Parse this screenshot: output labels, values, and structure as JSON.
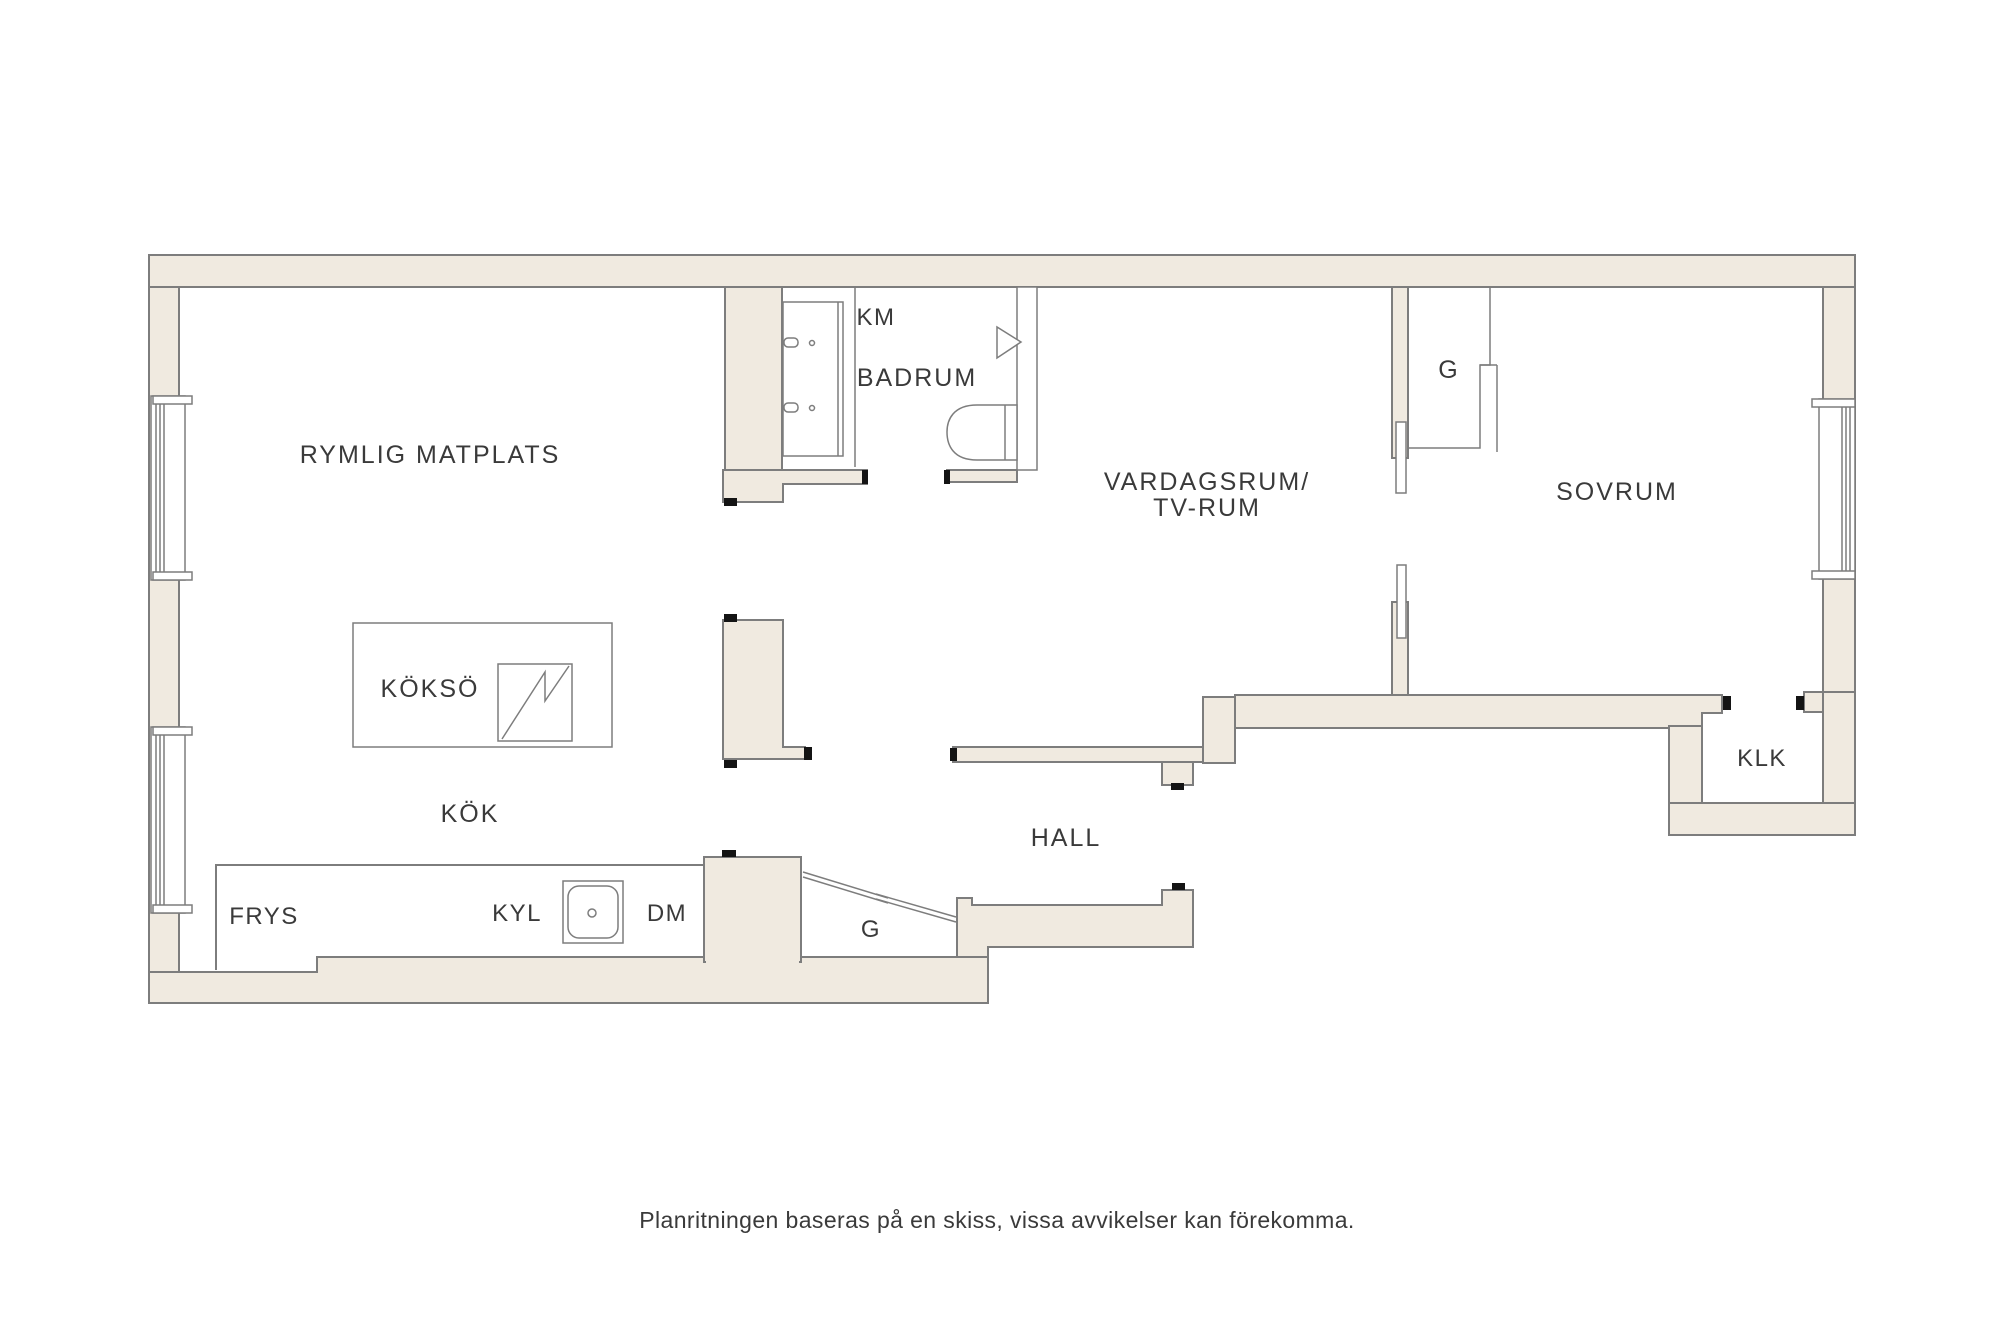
{
  "colors": {
    "wall_fill": "#F0EAE0",
    "wall_line": "#7D7D7D",
    "jamb": "#141414",
    "text": "#3A3A3A"
  },
  "labels": {
    "matplats": "RYMLIG MATPLATS",
    "km": "KM",
    "badrum": "BADRUM",
    "vardagsrum_line1": "VARDAGSRUM/",
    "vardagsrum_line2": "TV-RUM",
    "closet_top": "G",
    "sovrum": "SOVRUM",
    "kokso": "KÖKSÖ",
    "kok": "KÖK",
    "frys": "FRYS",
    "kyl": "KYL",
    "dm": "DM",
    "closet_entry": "G",
    "hall": "HALL",
    "klk": "KLK"
  },
  "footer": {
    "disclaimer": "Planritningen baseras på en skiss, vissa avvikelser kan förekomma."
  }
}
